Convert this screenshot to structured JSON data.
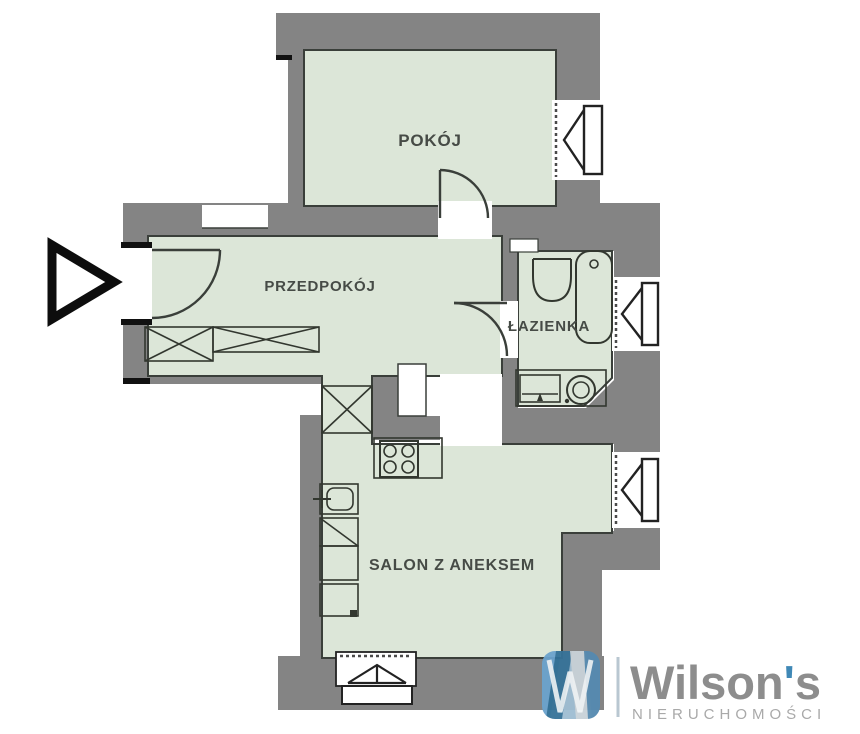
{
  "plan": {
    "rooms": [
      {
        "id": "pokoj",
        "label": "POKÓJ"
      },
      {
        "id": "przedpokoj",
        "label": "PRZEDPOKÓJ"
      },
      {
        "id": "lazienka",
        "label": "ŁAZIENKA"
      },
      {
        "id": "salon",
        "label": "SALON Z ANEKSEM"
      }
    ],
    "colors": {
      "wall_gray": "#848484",
      "room_fill": "#dce6d8",
      "outline": "#3a3f3a",
      "entrance_marker": "#0d0d0d"
    }
  },
  "logo": {
    "monogram": "W",
    "name_pre": "Wilson",
    "apostrophe": "'",
    "name_post": "s",
    "subtitle": "NIERUCHOMOŚCI",
    "accent_blue": "#3f88b6",
    "text_gray": "#8d8d8d"
  }
}
